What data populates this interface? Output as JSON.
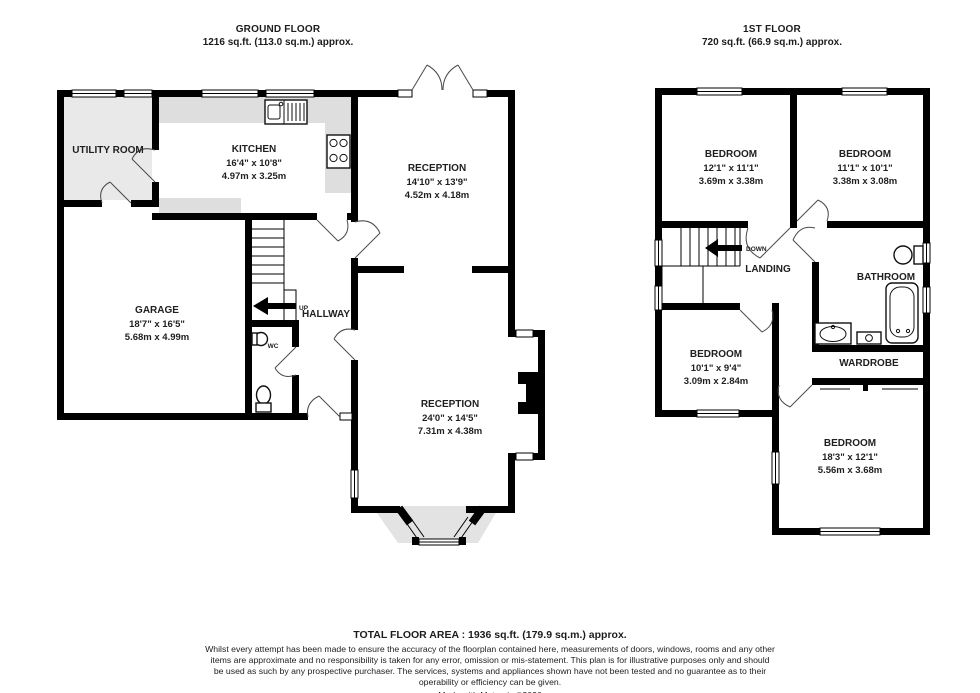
{
  "colors": {
    "wall": "#000000",
    "floor_shade": "#e7e7e7",
    "counter_shade": "#dedede",
    "label_text": "#1f1f1f"
  },
  "ground_floor": {
    "title": "GROUND FLOOR",
    "area": "1216 sq.ft. (113.0 sq.m.) approx.",
    "rooms": {
      "utility": {
        "name": "UTILITY ROOM"
      },
      "kitchen": {
        "name": "KITCHEN",
        "imperial": "16'4\" x 10'8\"",
        "metric": "4.97m x 3.25m"
      },
      "reception_front": {
        "name": "RECEPTION",
        "imperial": "14'10\" x 13'9\"",
        "metric": "4.52m x 4.18m"
      },
      "garage": {
        "name": "GARAGE",
        "imperial": "18'7\" x 16'5\"",
        "metric": "5.68m x 4.99m"
      },
      "hallway": {
        "name": "HALLWAY"
      },
      "wc": {
        "name": "WC"
      },
      "stairs_label": "UP",
      "reception_rear": {
        "name": "RECEPTION",
        "imperial": "24'0\" x 14'5\"",
        "metric": "7.31m x 4.38m"
      }
    }
  },
  "first_floor": {
    "title": "1ST FLOOR",
    "area": "720 sq.ft. (66.9 sq.m.) approx.",
    "rooms": {
      "bedroom1": {
        "name": "BEDROOM",
        "imperial": "12'1\" x 11'1\"",
        "metric": "3.69m x 3.38m"
      },
      "bedroom2": {
        "name": "BEDROOM",
        "imperial": "11'1\" x 10'1\"",
        "metric": "3.38m x 3.08m"
      },
      "landing": {
        "name": "LANDING"
      },
      "stairs_label": "DOWN",
      "bathroom": {
        "name": "BATHROOM"
      },
      "wardrobe": {
        "name": "WARDROBE"
      },
      "bedroom3": {
        "name": "BEDROOM",
        "imperial": "10'1\" x 9'4\"",
        "metric": "3.09m x 2.84m"
      },
      "bedroom4": {
        "name": "BEDROOM",
        "imperial": "18'3\" x 12'1\"",
        "metric": "5.56m x 3.68m"
      }
    }
  },
  "footer": {
    "total": "TOTAL FLOOR AREA : 1936 sq.ft. (179.9 sq.m.) approx.",
    "disclaimer": "Whilst every attempt has been made to ensure the accuracy of the floorplan contained here, measurements of doors, windows, rooms and any other items are approximate and no responsibility is taken for any error, omission or mis-statement. This plan is for illustrative purposes only and should be used as such by any prospective purchaser. The services, systems and appliances shown have not been tested and no guarantee as to their operability or efficiency can be given.",
    "credit": "Made with Metropix ©2026"
  }
}
